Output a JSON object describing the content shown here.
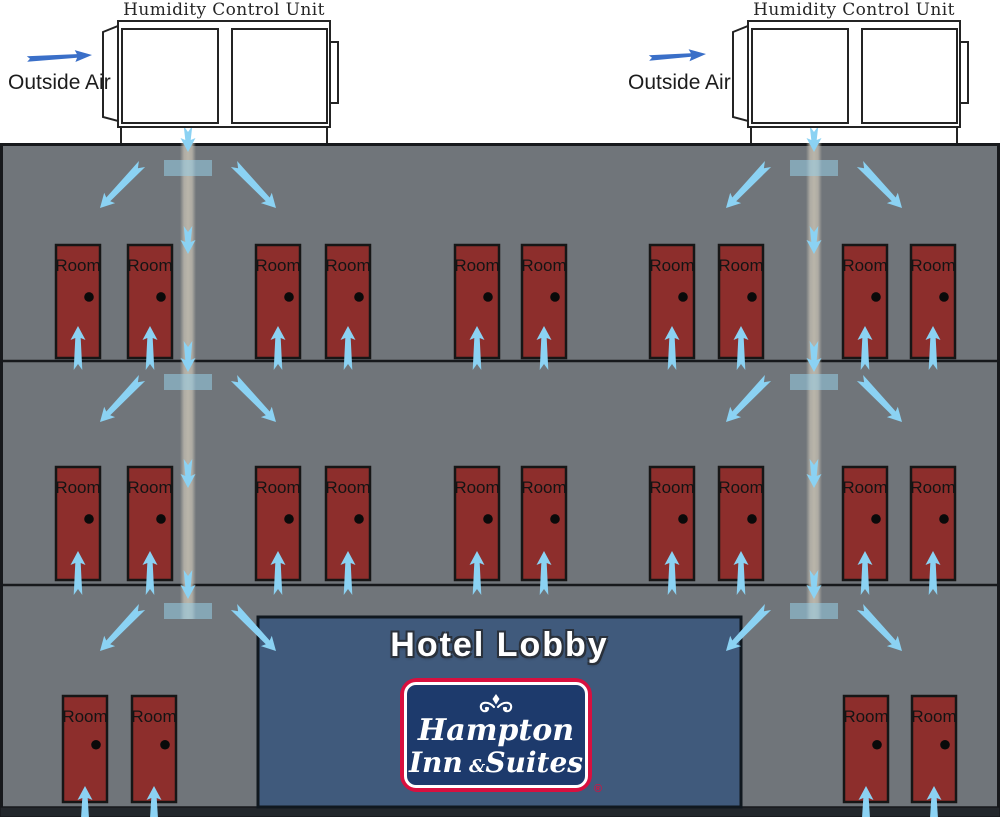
{
  "labels": {
    "humidity_unit": "Humidity Control Unit",
    "outside_air": "Outside Air",
    "hotel_lobby": "Hotel Lobby",
    "room": "Room",
    "registered": "®"
  },
  "logo": {
    "hampton": "Hampton",
    "inn": "Inn",
    "amp": "&",
    "suites": "Suites",
    "ornament": "fleur-de-lis"
  },
  "colors": {
    "building": "#70757a",
    "line": "#17191c",
    "strip": "#23272c",
    "door": "#8d2e2c",
    "door_border": "#161616",
    "knob": "#0a0a0a",
    "arrow": "#8bd2f3",
    "outside_arrow": "#3a6fc8",
    "lobby": "#405a7c",
    "lobby_border": "#10181f",
    "duct": "#b9b5aa",
    "diffuser": "rgba(152,205,229,0.55)",
    "unit_stroke": "#242424",
    "unit_fill": "#ffffff",
    "logo_red": "#d8103f",
    "logo_navy": "#1d3a6c",
    "room_text": "#141414"
  },
  "diagram": {
    "canvas": {
      "w": 1000,
      "h": 817
    },
    "building": {
      "x": 0,
      "y": 143,
      "w": 1000,
      "h": 674,
      "floor_lines": [
        361,
        585
      ],
      "strip_y": 807
    },
    "lobby": {
      "x": 258,
      "y": 617,
      "w": 483,
      "h": 190
    },
    "units": [
      {
        "x": 118,
        "duct_x": 188,
        "air_arrow": {
          "tail": [
            27,
            59
          ],
          "tip": [
            92,
            55
          ]
        }
      },
      {
        "x": 748,
        "duct_x": 814,
        "air_arrow": {
          "tail": [
            649,
            58
          ],
          "tip": [
            706,
            54
          ]
        }
      }
    ],
    "unit_geom": {
      "y": 21,
      "w": 212,
      "h": 106,
      "panel_y": 29,
      "panel_h": 94,
      "panel1_dx": 4,
      "panel1_w": 96,
      "panel2_dx": 114,
      "panel2_w": 95,
      "tab_y": 42,
      "tab_h": 61,
      "leg_bottom": 143
    },
    "duct": {
      "top": 143,
      "bottom": 619,
      "width": 16
    },
    "diffuser_rows": [
      160,
      374,
      603
    ],
    "diffuser": {
      "w": 48,
      "h": 16
    },
    "vertical_arrow_segments": [
      [
        126,
        152
      ],
      [
        226,
        254
      ],
      [
        341,
        372
      ],
      [
        459,
        488
      ],
      [
        570,
        599
      ]
    ],
    "diagonal_arrow": {
      "tail_dx": 46,
      "tail_dy": 4,
      "tip_dx": 88,
      "tip_dy": 48
    },
    "door_w": 44,
    "floors": [
      {
        "door_y": 245,
        "door_h": 113,
        "doors": [
          56,
          128,
          256,
          326,
          455,
          522,
          650,
          719,
          843,
          911
        ],
        "arrow_tip": 326,
        "arrow_tail": 370
      },
      {
        "door_y": 467,
        "door_h": 113,
        "doors": [
          56,
          128,
          256,
          326,
          455,
          522,
          650,
          719,
          843,
          911
        ],
        "arrow_tip": 551,
        "arrow_tail": 595
      },
      {
        "door_y": 696,
        "door_h": 106,
        "doors": [
          63,
          132,
          844,
          912
        ],
        "arrow_tip": 786,
        "arrow_tail": 823
      }
    ]
  }
}
